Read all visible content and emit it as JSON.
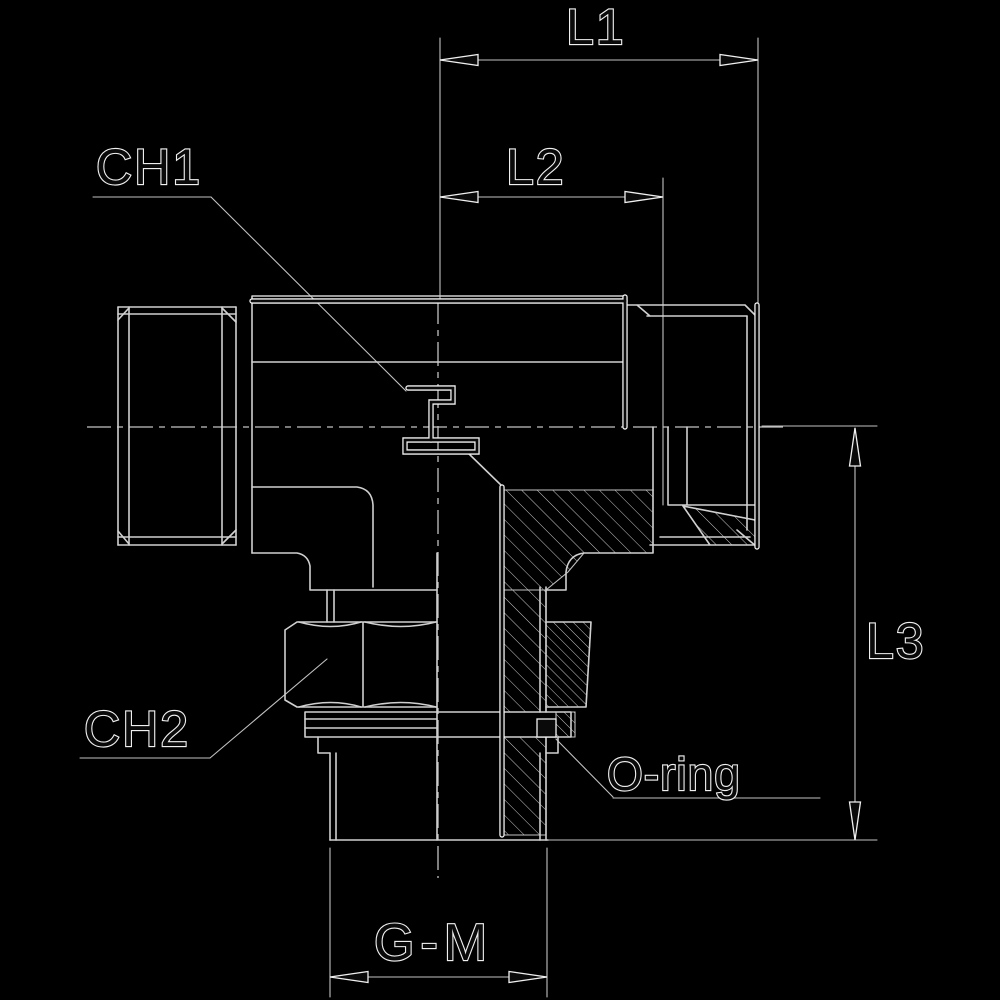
{
  "drawing": {
    "title": "Tee fitting sectional technical drawing",
    "dimension_labels": {
      "l1": "L1",
      "l2": "L2",
      "l3": "L3",
      "gm": "G-M"
    },
    "callout_labels": {
      "ch1": "CH1",
      "ch2": "CH2",
      "oring": "O-ring"
    },
    "colors": {
      "background": "#000000",
      "line": "#d0d0d0",
      "thin_line": "#c2c2c2",
      "ink": "#0a0a0a",
      "halo": "#f0f0f0"
    }
  }
}
